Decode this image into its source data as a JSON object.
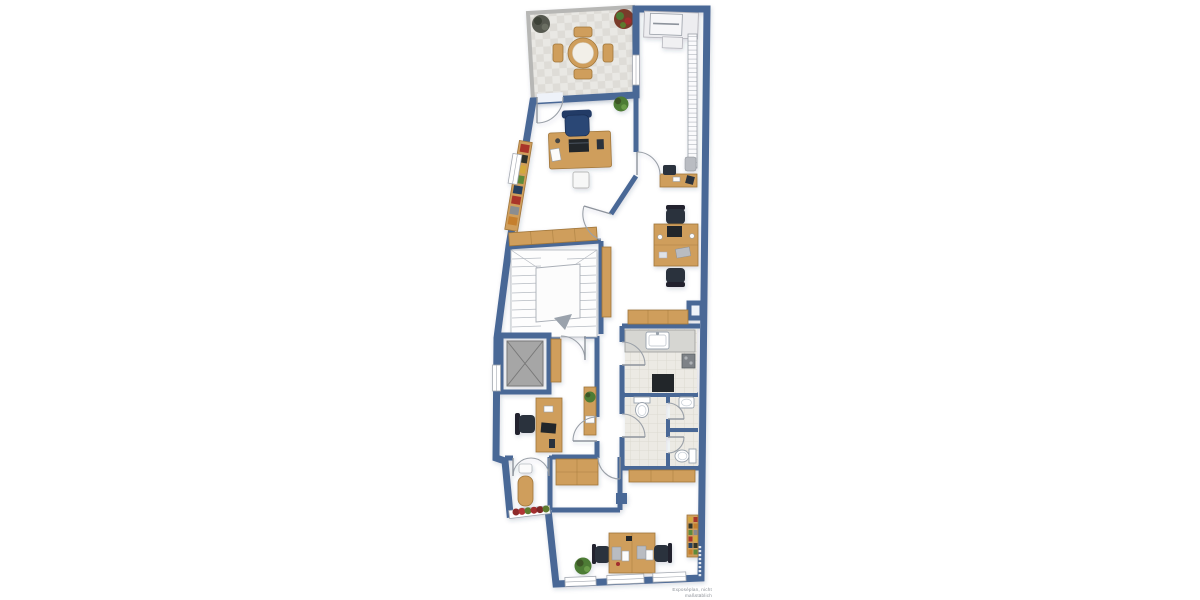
{
  "caption": "Exposéplan, nicht maßstäblich",
  "palette": {
    "wall": "#4a6896",
    "floor": "#eef2f9",
    "terrace_wall": "#b7b7b5",
    "terrace_tile": "#e9e8e4",
    "terrace_tile_alt": "#dedcd7",
    "wood": "#cf9e5b",
    "wood_border": "#a0763a",
    "counter": "#d6d6d2",
    "tile": "#eceae4",
    "tile_line": "#d9d6cd",
    "chair": "#2c313c",
    "chair_blue": "#2a4675",
    "elevator_cab": "#a6a6a6",
    "appliance": "#24262b",
    "plant": "#4e7c35",
    "plant_dark": "#3c5428",
    "flower": "#a22d2d",
    "stair": "#b6bbc2",
    "arc": "#9aa0a8",
    "frame": "#a3a8b0"
  },
  "plan": {
    "type": "floor-plan",
    "scale_note_visible": true,
    "rooms": [
      {
        "name": "terrace",
        "floor": "stone-tiles",
        "furniture": [
          "round-dining-table",
          "chair",
          "chair",
          "chair",
          "chair",
          "plant",
          "plant"
        ]
      },
      {
        "name": "office-upper",
        "furniture": [
          "desk",
          "office-chair",
          "laptop",
          "bookshelf",
          "waste-bin"
        ]
      },
      {
        "name": "utility-room-top-right",
        "furniture": [
          "printer-desk",
          "wall-radiator-shelf"
        ]
      },
      {
        "name": "hallway",
        "furniture": [
          "sideboard",
          "sideboard",
          "console-desk",
          "chair",
          "plant"
        ]
      },
      {
        "name": "open-office-middle",
        "furniture": [
          "double-desk",
          "office-chair",
          "office-chair",
          "sideboard"
        ]
      },
      {
        "name": "stairwell",
        "furniture": [
          "staircase",
          "direction-arrow"
        ]
      },
      {
        "name": "elevator",
        "furniture": [
          "elevator-cab"
        ]
      },
      {
        "name": "office-left",
        "furniture": [
          "desk",
          "office-chair",
          "sideboard",
          "plant"
        ]
      },
      {
        "name": "kitchen",
        "floor": "tiles",
        "furniture": [
          "counter",
          "sink",
          "cooktop",
          "refrigerator"
        ]
      },
      {
        "name": "bathroom",
        "floor": "tiles",
        "furniture": [
          "toilet",
          "wash-basin"
        ]
      },
      {
        "name": "wc",
        "floor": "tiles",
        "furniture": [
          "toilet"
        ]
      },
      {
        "name": "vestibule",
        "furniture": [
          "cabinet"
        ]
      },
      {
        "name": "balcony-bay",
        "furniture": [
          "table",
          "chair",
          "flower-box"
        ]
      },
      {
        "name": "office-bottom",
        "furniture": [
          "double-desk",
          "office-chair",
          "office-chair",
          "bookshelf",
          "sideboard",
          "plant",
          "column"
        ]
      }
    ]
  }
}
